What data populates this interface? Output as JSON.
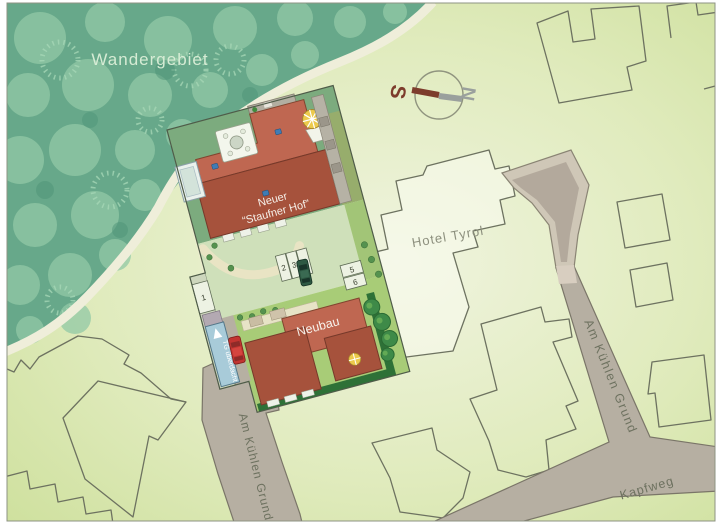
{
  "map": {
    "region_label": "Wandergebiet",
    "main_building": {
      "line1": "Neuer",
      "line2": "“Staufner Hof”"
    },
    "neubau_label": "Neubau",
    "hotel_label": "Hotel Tyrol",
    "street_left": "Am Kühlen Grund",
    "street_right": "Am Kühlen Grund",
    "street_bottom": "Kapfweg",
    "garage_ramp": "TG überdacht",
    "parking_spaces": [
      "1",
      "2",
      "3",
      "4",
      "5",
      "6"
    ],
    "compass": {
      "south": "S",
      "north": "N"
    },
    "colors": {
      "forest": "#67a88a",
      "forest_trees": "#92c9a6",
      "field_light": "#eef3d8",
      "field_dark": "#c9dd94",
      "parcel_garden": "#7cab7e",
      "courtyard": "#cfe0ba",
      "lawn": "#a8cc77",
      "roof_light": "#bf6751",
      "roof_dark": "#a6523c",
      "road": "#b6afa2",
      "ramp_blue": "#a8cbd9",
      "hedge": "#2e7137",
      "compass_south": "#7d3c2c",
      "compass_north": "#9aa09d"
    }
  }
}
